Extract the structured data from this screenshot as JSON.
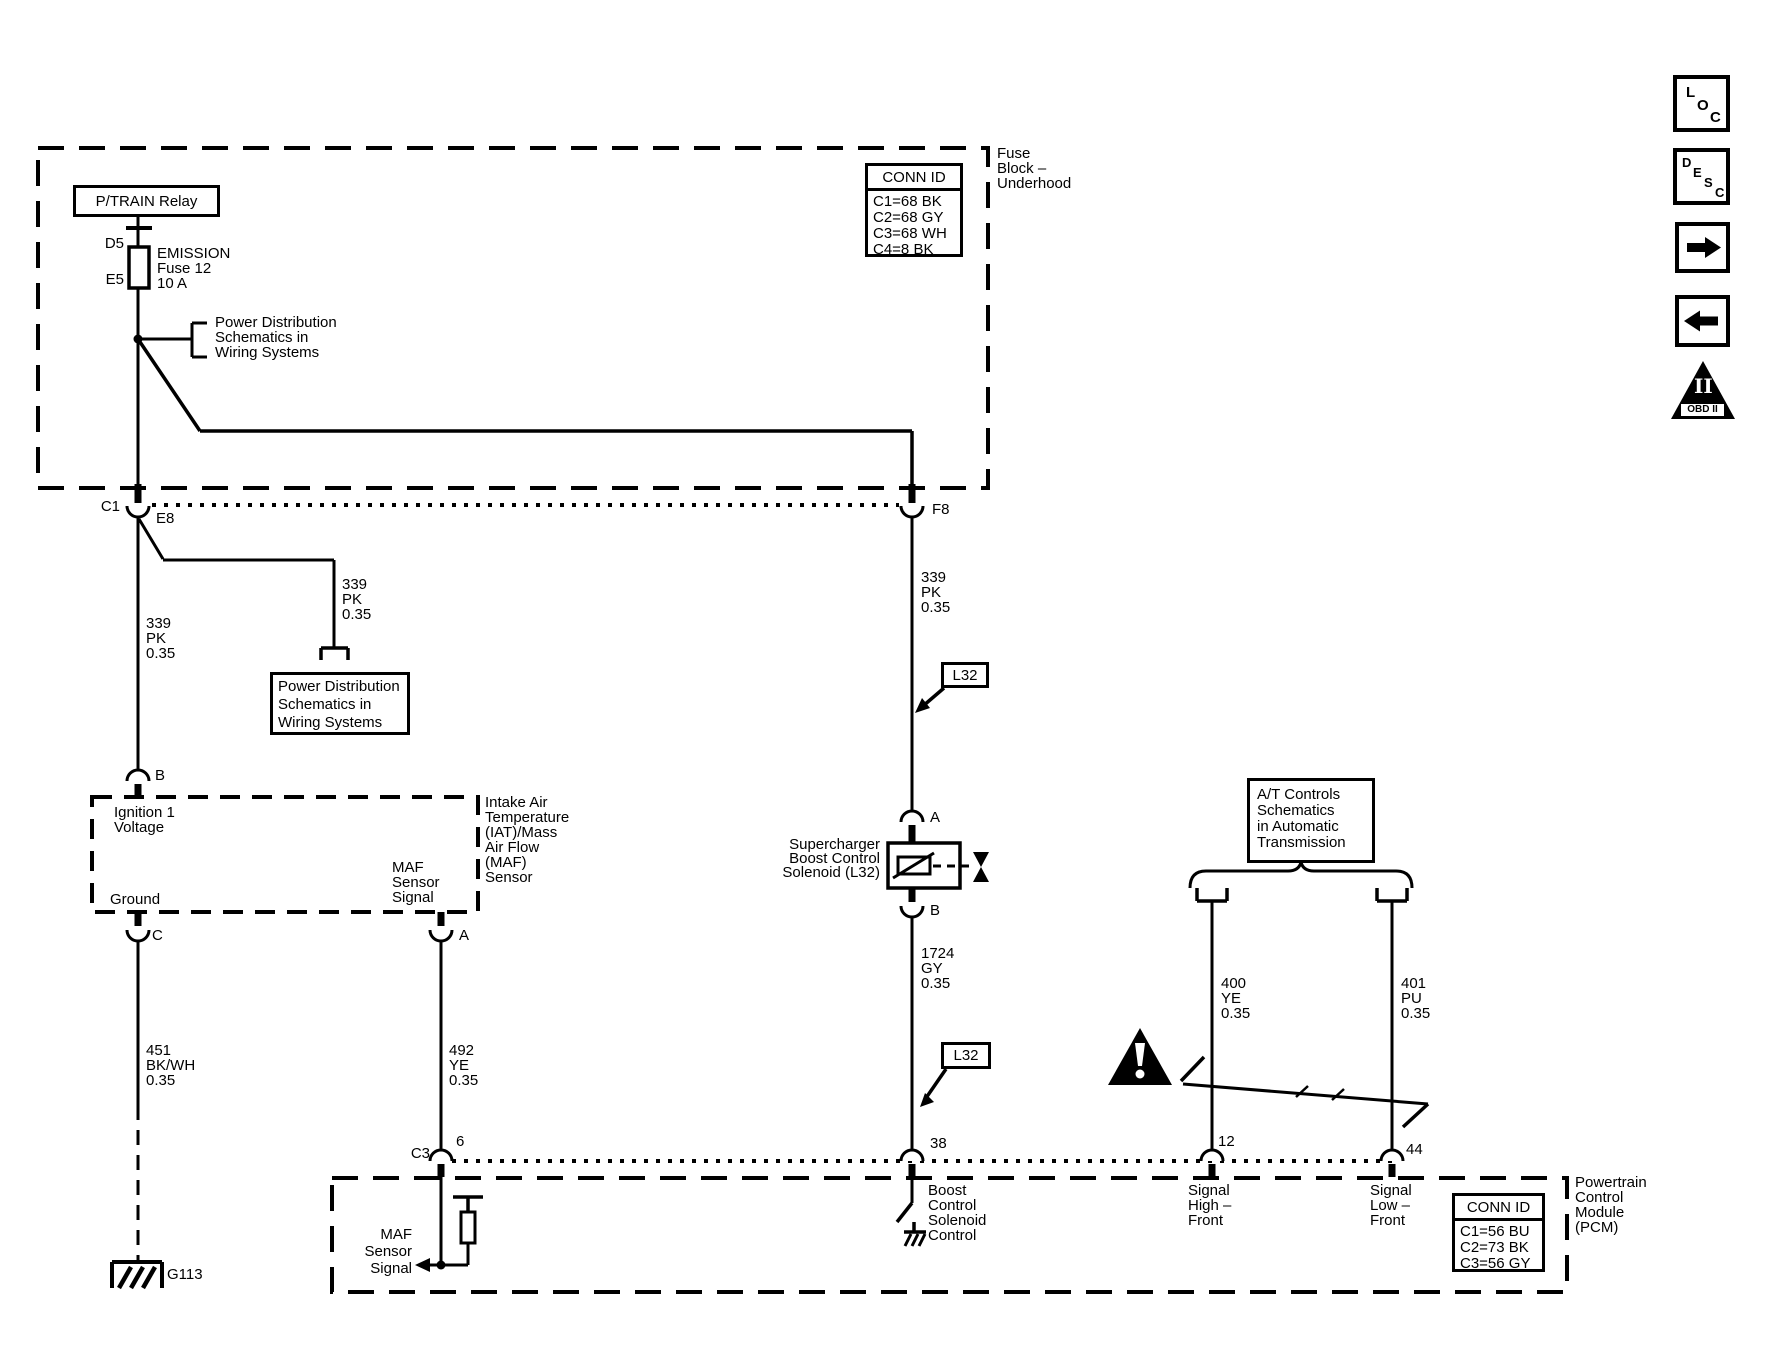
{
  "nav": {
    "loc": [
      "L",
      "O",
      "C"
    ],
    "desc": [
      "D",
      "E",
      "S",
      "C"
    ],
    "obd_numeral": "II",
    "obd_label": "OBD II"
  },
  "fuse_block": {
    "label": [
      "Fuse",
      "Block –",
      "Underhood"
    ],
    "conn_id": {
      "header": "CONN ID",
      "rows": [
        "C1=68 BK",
        "C2=68 GY",
        "C3=68 WH",
        "C4=8 BK"
      ]
    },
    "relay_label": "P/TRAIN Relay",
    "fuse_top_pin": "D5",
    "fuse_bottom_pin": "E5",
    "fuse_label": [
      "EMISSION",
      "Fuse 12",
      "10 A"
    ],
    "power_dist_ref": [
      "Power Distribution",
      "Schematics in",
      "Wiring Systems"
    ]
  },
  "connectors": {
    "c1": "C1",
    "e8": "E8",
    "f8": "F8",
    "maf_b": "B",
    "maf_c": "C",
    "maf_a": "A",
    "sol_a": "A",
    "sol_b": "B",
    "c3": "C3",
    "pin6": "6",
    "pin38": "38",
    "pin12": "12",
    "pin44": "44"
  },
  "wires": {
    "w339_left": [
      "339",
      "PK",
      "0.35"
    ],
    "w339_branch": [
      "339",
      "PK",
      "0.35"
    ],
    "w339_right": [
      "339",
      "PK",
      "0.35"
    ],
    "w1724": [
      "1724",
      "GY",
      "0.35"
    ],
    "w451": [
      "451",
      "BK/WH",
      "0.35"
    ],
    "w492": [
      "492",
      "YE",
      "0.35"
    ],
    "w400": [
      "400",
      "YE",
      "0.35"
    ],
    "w401": [
      "401",
      "PU",
      "0.35"
    ]
  },
  "refs": {
    "power_dist_box": [
      "Power Distribution",
      "Schematics in",
      "Wiring Systems"
    ],
    "l32_upper": "L32",
    "l32_lower": "L32",
    "at_controls": [
      "A/T Controls",
      "Schematics",
      "in Automatic",
      "Transmission"
    ]
  },
  "maf_sensor": {
    "ignition": [
      "Ignition 1",
      "Voltage"
    ],
    "ground": "Ground",
    "signal": [
      "MAF",
      "Sensor",
      "Signal"
    ],
    "label": [
      "Intake Air",
      "Temperature",
      "(IAT)/Mass",
      "Air Flow",
      "(MAF)",
      "Sensor"
    ]
  },
  "solenoid_label": [
    "Supercharger",
    "Boost Control",
    "Solenoid (L32)"
  ],
  "ground_id": "G113",
  "pcm": {
    "label": [
      "Powertrain",
      "Control",
      "Module",
      "(PCM)"
    ],
    "conn_id": {
      "header": "CONN ID",
      "rows": [
        "C1=56 BU",
        "C2=73 BK",
        "C3=56 GY"
      ]
    },
    "boost_control": [
      "Boost",
      "Control",
      "Solenoid",
      "Control"
    ],
    "maf_signal": [
      "MAF",
      "Sensor",
      "Signal"
    ],
    "signal_high": [
      "Signal",
      "High –",
      "Front"
    ],
    "signal_low": [
      "Signal",
      "Low –",
      "Front"
    ]
  }
}
